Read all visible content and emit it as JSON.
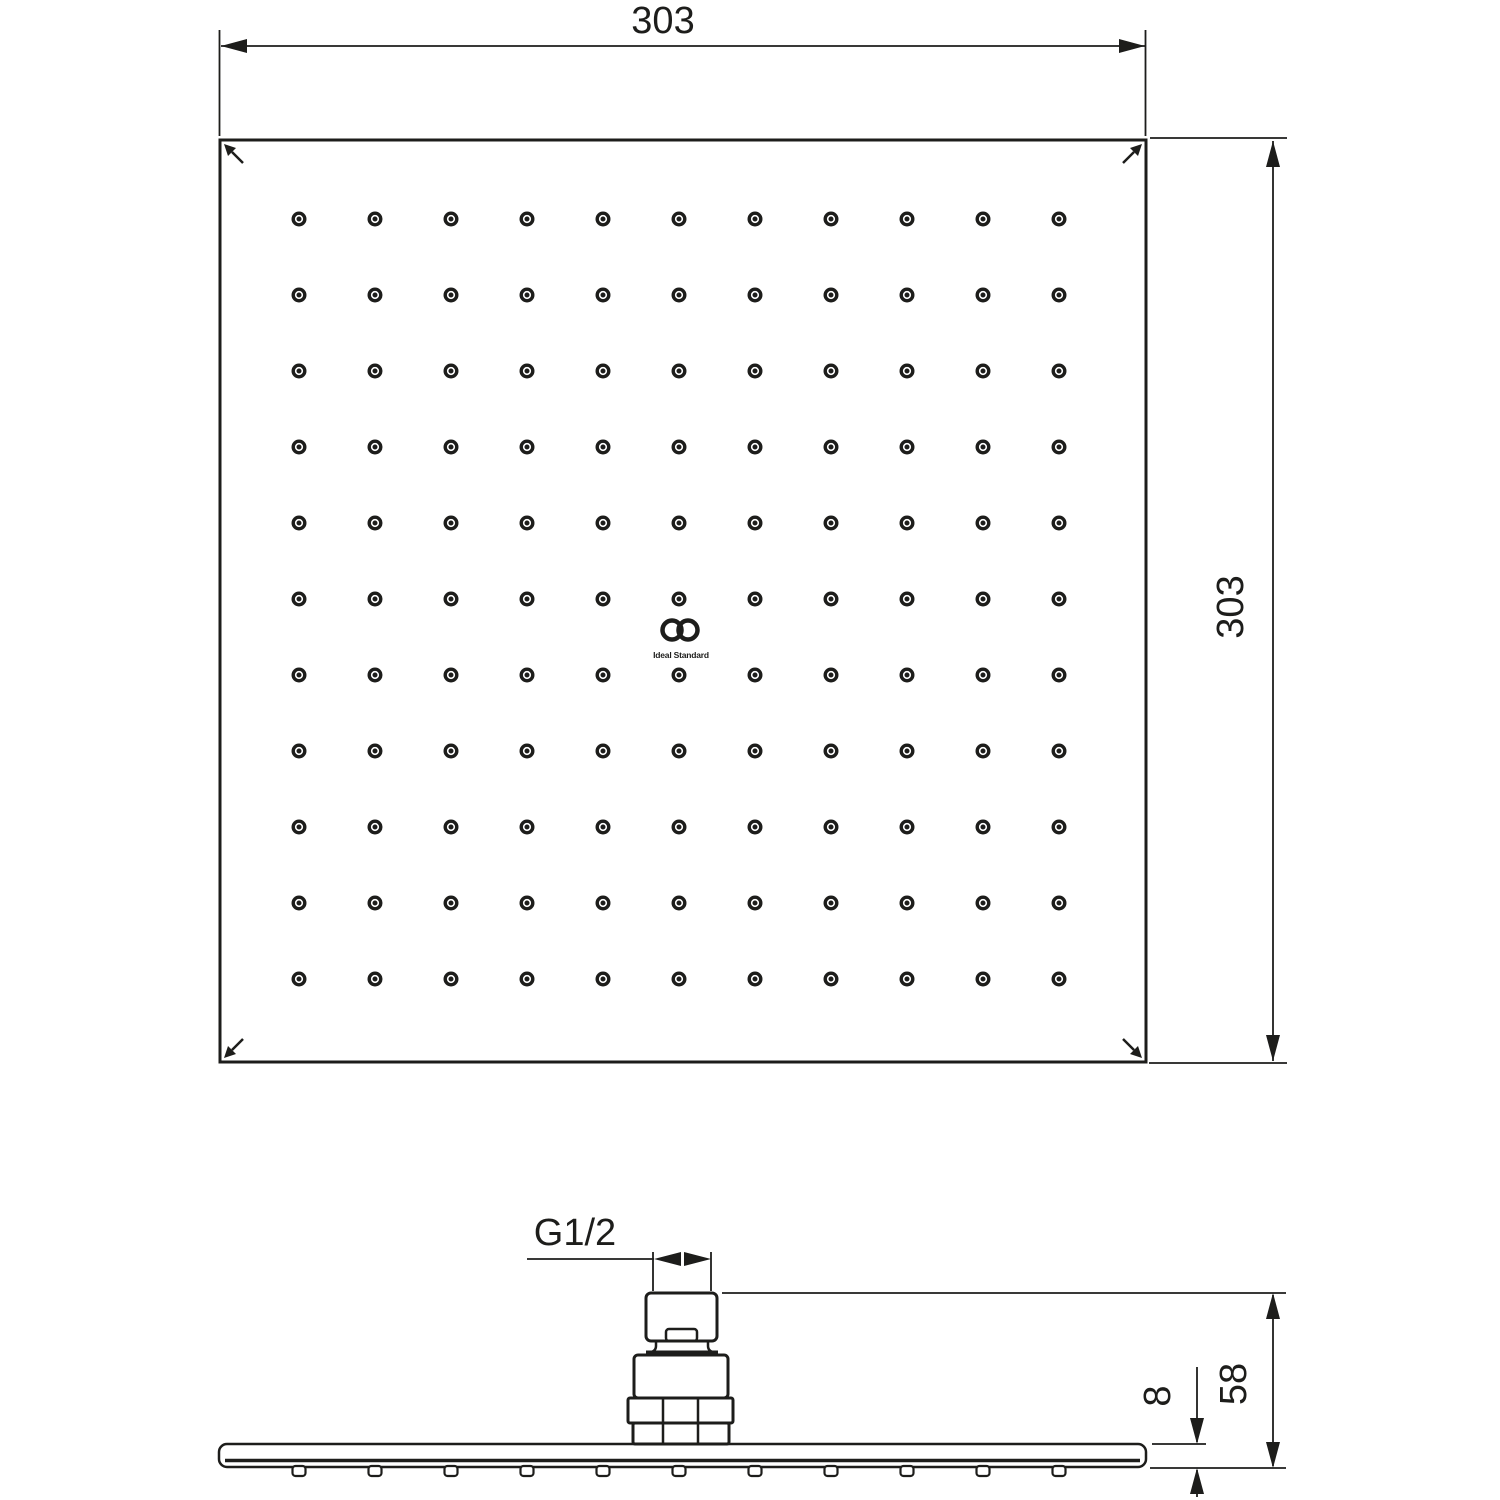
{
  "page": {
    "description": "Technical dimension drawing of a square rain shower head, top view and side view",
    "line_color": "#1d1d1b",
    "background_color": "#ffffff"
  },
  "top_view": {
    "width_label": "303",
    "height_label": "303",
    "nozzle_rows": 11,
    "nozzle_cols": 11,
    "logo_text": "Ideal Standard"
  },
  "side_view": {
    "thread_label": "G1/2",
    "total_height_label": "58",
    "plate_thickness_label": "8",
    "tick_count": 11
  }
}
